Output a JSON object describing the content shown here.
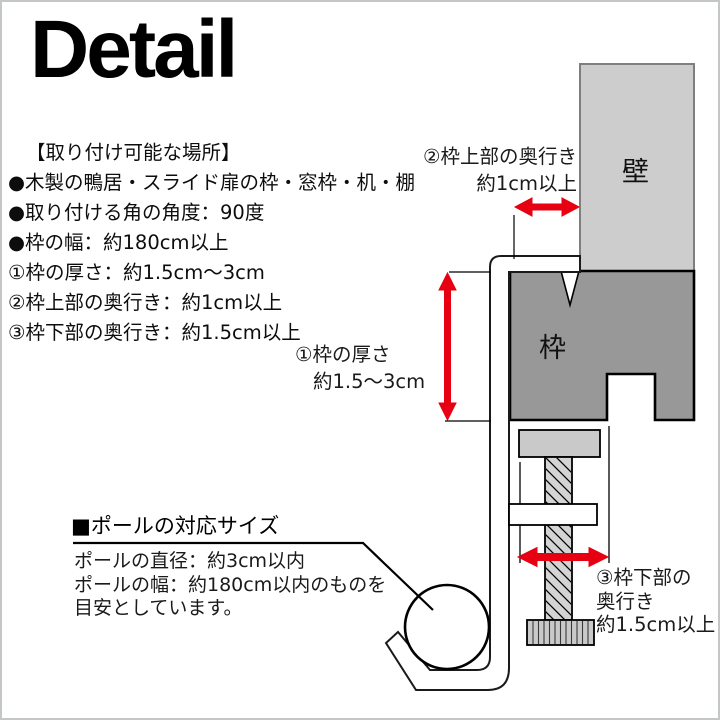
{
  "title": "Detail",
  "colors": {
    "accent_red": "#e60012",
    "wall_gray": "#cdcdcd",
    "frame_gray": "#989898"
  },
  "info": {
    "heading": "【取り付け可能な場所】",
    "lines": [
      "●木製の鴨居・スライド扉の枠・窓枠・机・棚",
      "●取り付ける角の角度：90度",
      "●枠の幅：約180cm以上",
      "①枠の厚さ：約1.5cm～3cm",
      "②枠上部の奥行き：約1cm以上",
      "③枠下部の奥行き：約1.5cm以上"
    ]
  },
  "diagram": {
    "wall_label": "壁",
    "frame_label": "枠",
    "dim_top_depth": {
      "line1": "②枠上部の奥行き",
      "line2": "約1cm以上"
    },
    "dim_thickness": {
      "line1": "①枠の厚さ",
      "line2": "約1.5～3cm"
    },
    "dim_bottom_depth": {
      "line1": "③枠下部の",
      "line2": "奥行き",
      "line3": "約1.5cm以上"
    }
  },
  "pole": {
    "heading": "■ポールの対応サイズ",
    "lines": [
      "ポールの直径：約3cm以内",
      "ポールの幅：約180cm以内のものを",
      "目安としています。"
    ]
  }
}
